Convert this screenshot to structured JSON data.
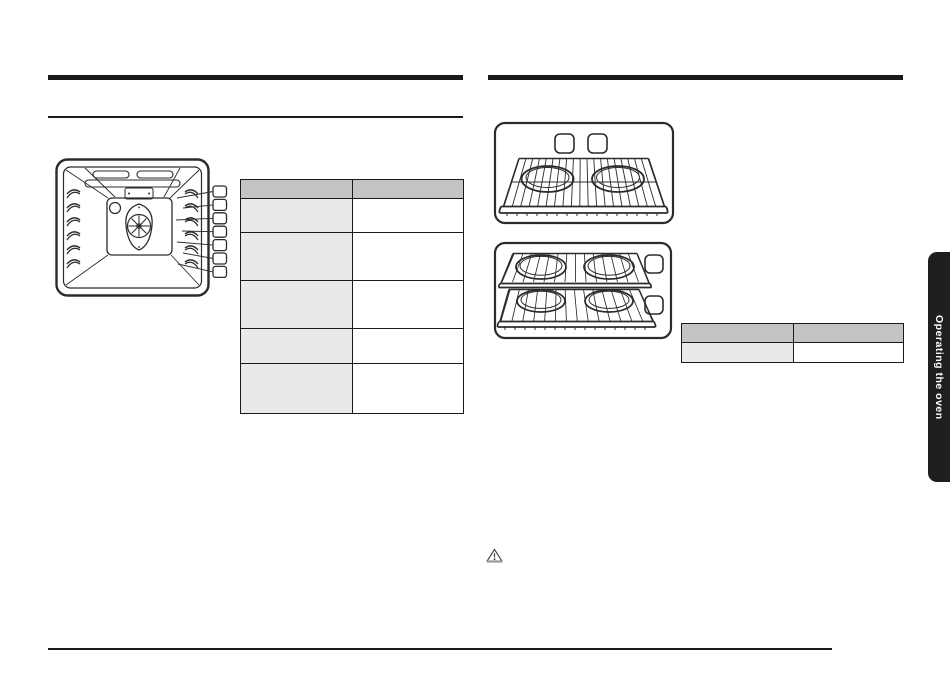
{
  "page": {
    "type": "user-manual-page",
    "background": "#ffffff",
    "rule_color": "#1a1a1a"
  },
  "side_tab": {
    "label": "Operating the oven",
    "background": "#1f1f1f",
    "text_color": "#ffffff"
  },
  "left_column": {
    "diagram": "oven-cavity-rack-positions-diagram",
    "callout_count": 7,
    "table": {
      "header": [
        "",
        ""
      ],
      "rows": [
        [
          "",
          ""
        ],
        [
          "",
          ""
        ],
        [
          "",
          ""
        ],
        [
          "",
          ""
        ],
        [
          "",
          ""
        ]
      ],
      "header_bg": "#c4c4c4",
      "label_col_bg": "#e9e9e9",
      "border_color": "#1a1a1a"
    }
  },
  "right_column": {
    "illustrations": [
      "single-rack-with-two-pans",
      "two-racks-with-four-pans"
    ],
    "table": {
      "header": [
        "",
        ""
      ],
      "rows": [
        [
          "",
          ""
        ]
      ],
      "header_bg": "#c4c4c4",
      "label_col_bg": "#e9e9e9",
      "border_color": "#1a1a1a"
    },
    "warning_icon": "warning-triangle-icon"
  }
}
